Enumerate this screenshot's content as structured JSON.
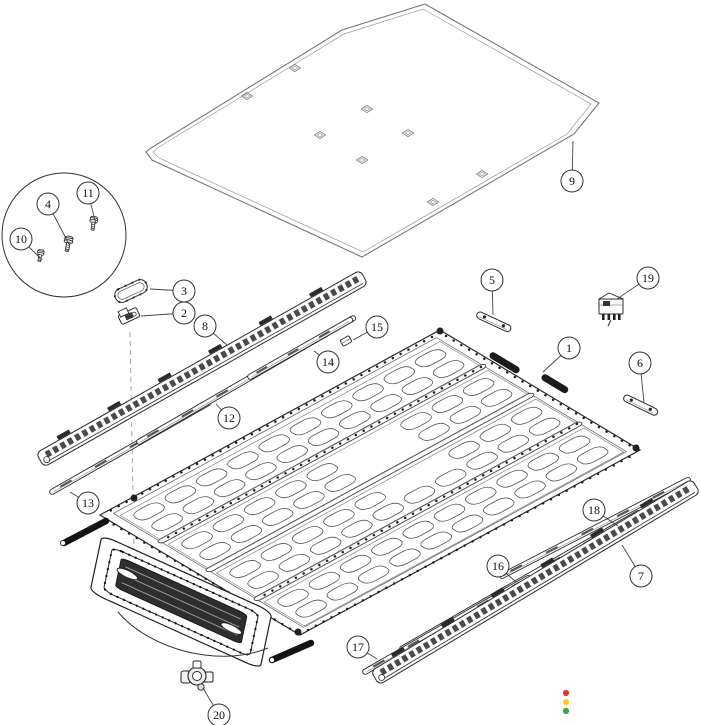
{
  "diagram": {
    "background_color": "#ffffff",
    "line_color": "#2b2b2b",
    "cover_line_color": "#777777",
    "callouts": [
      {
        "label": "1",
        "cx": 569,
        "cy": 348,
        "tx": 543,
        "ty": 372
      },
      {
        "label": "2",
        "cx": 184,
        "cy": 313,
        "tx": 141,
        "ty": 316
      },
      {
        "label": "3",
        "cx": 184,
        "cy": 291,
        "tx": 150,
        "ty": 289
      },
      {
        "label": "4",
        "cx": 48,
        "cy": 204,
        "tx": 70,
        "ty": 246
      },
      {
        "label": "5",
        "cx": 492,
        "cy": 280,
        "tx": 493,
        "ty": 315
      },
      {
        "label": "6",
        "cx": 640,
        "cy": 363,
        "tx": 644,
        "ty": 403
      },
      {
        "label": "7",
        "cx": 641,
        "cy": 576,
        "tx": 622,
        "ty": 545
      },
      {
        "label": "8",
        "cx": 205,
        "cy": 326,
        "tx": 227,
        "ty": 345
      },
      {
        "label": "9",
        "cx": 572,
        "cy": 181,
        "tx": 573,
        "ty": 141
      },
      {
        "label": "10",
        "cx": 21,
        "cy": 239,
        "tx": 42,
        "ty": 260
      },
      {
        "label": "11",
        "cx": 88,
        "cy": 193,
        "tx": 96,
        "ty": 224
      },
      {
        "label": "12",
        "cx": 229,
        "cy": 418,
        "tx": 216,
        "ty": 404
      },
      {
        "label": "13",
        "cx": 88,
        "cy": 503,
        "tx": 70,
        "ty": 492
      },
      {
        "label": "14",
        "cx": 328,
        "cy": 362,
        "tx": 314,
        "ty": 351
      },
      {
        "label": "15",
        "cx": 377,
        "cy": 327,
        "tx": 353,
        "ty": 340
      },
      {
        "label": "16",
        "cx": 498,
        "cy": 566,
        "tx": 516,
        "ty": 582
      },
      {
        "label": "17",
        "cx": 358,
        "cy": 647,
        "tx": 377,
        "ty": 659
      },
      {
        "label": "18",
        "cx": 594,
        "cy": 510,
        "tx": 618,
        "ty": 526
      },
      {
        "label": "19",
        "cx": 648,
        "cy": 278,
        "tx": 617,
        "ty": 299
      },
      {
        "label": "20",
        "cx": 219,
        "cy": 715,
        "tx": 203,
        "ty": 688
      }
    ],
    "status_dots": [
      {
        "name": "red-status-dot",
        "color": "#e23a30",
        "cx": 566,
        "cy": 693,
        "r": 3.1
      },
      {
        "name": "yellow-status-dot",
        "color": "#f5d41c",
        "cx": 566,
        "cy": 702,
        "r": 3.1
      },
      {
        "name": "green-status-dot",
        "color": "#3da448",
        "cx": 566,
        "cy": 711,
        "r": 3.1
      }
    ]
  }
}
